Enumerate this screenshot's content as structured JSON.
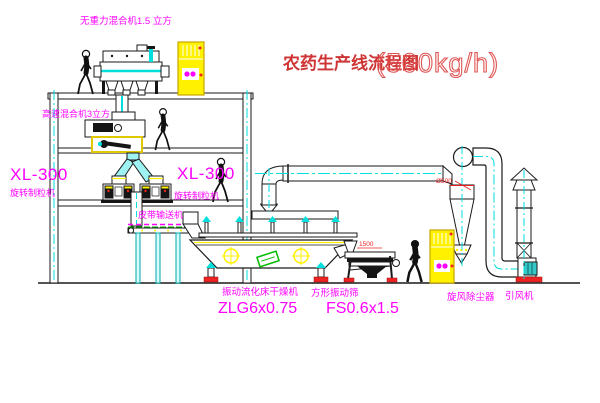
{
  "title": {
    "main": "农药生产线流程图",
    "capacity": "(500kg/h)"
  },
  "labels": {
    "top_mixer": "无重力混合机1.5 立方",
    "hs_mixer": "高速混合机3立方",
    "granulator_left_model": "XL-300",
    "granulator_left_name": "旋转制粒机",
    "granulator_right_model": "XL-300",
    "granulator_right_name": "旋转制粒机",
    "conveyor": "皮带输送机",
    "dryer_name": "振动流化床干燥机",
    "dryer_model": "ZLG6x0.75",
    "screen_name": "方形振动筛",
    "screen_model": "FS0.6x1.5",
    "cyclone_name": "旋风除尘器",
    "fan_name": "引风机"
  },
  "dimensions": {
    "cyclone_diameter": "Ø500",
    "screen_length": "1500"
  },
  "colors": {
    "label_magenta": "#ff00ff",
    "title_red": "#cf3434",
    "equipment_yellow": "#fff100",
    "centerline_cyan": "#00dede",
    "line_black": "#1a1a1a",
    "accent_red": "#ee2222",
    "accent_green": "#00bb00"
  }
}
